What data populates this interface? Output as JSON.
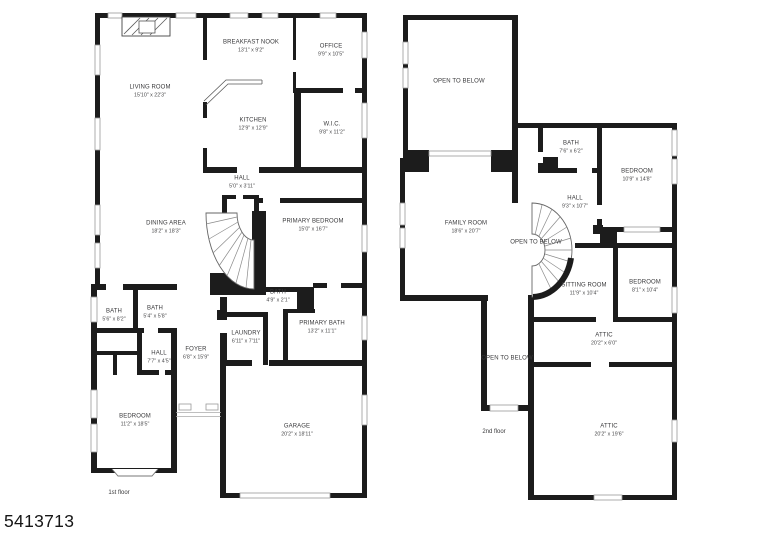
{
  "page": {
    "mls_number": "5413713"
  },
  "colors": {
    "wall": "#1c1c1c",
    "window_line": "#9a9a9a",
    "label_text": "#3a3a3c",
    "background": "#ffffff"
  },
  "floor1": {
    "floor_label": "1st floor",
    "rooms": [
      {
        "name": "LIVING ROOM",
        "dims": "15'10\" x 22'3\""
      },
      {
        "name": "BREAKFAST NOOK",
        "dims": "13'1\" x 9'2\""
      },
      {
        "name": "OFFICE",
        "dims": "9'9\" x 10'5\""
      },
      {
        "name": "KITCHEN",
        "dims": "12'9\" x 12'9\""
      },
      {
        "name": "W.I.C.",
        "dims": "9'8\" x 11'2\""
      },
      {
        "name": "HALL",
        "dims": "5'0\" x 3'11\""
      },
      {
        "name": "DINING AREA",
        "dims": "18'2\" x 18'3\""
      },
      {
        "name": "PRIMARY BEDROOM",
        "dims": "15'0\" x 16'7\""
      },
      {
        "name": "BATH",
        "dims": "5'6\" x 8'2\""
      },
      {
        "name": "BATH",
        "dims": "5'4\" x 5'8\""
      },
      {
        "name": "BATH",
        "dims": "4'9\" x 2'1\""
      },
      {
        "name": "PRIMARY BATH",
        "dims": "13'2\" x 11'1\""
      },
      {
        "name": "LAUNDRY",
        "dims": "6'11\" x 7'11\""
      },
      {
        "name": "FOYER",
        "dims": "6'8\" x 15'9\""
      },
      {
        "name": "HALL",
        "dims": "7'7\" x 4'5\""
      },
      {
        "name": "BEDROOM",
        "dims": "11'2\" x 18'5\""
      },
      {
        "name": "GARAGE",
        "dims": "20'2\" x 18'11\""
      }
    ]
  },
  "floor2": {
    "floor_label": "2nd floor",
    "rooms": [
      {
        "name": "OPEN TO BELOW",
        "dims": ""
      },
      {
        "name": "BATH",
        "dims": "7'6\" x 6'2\""
      },
      {
        "name": "BEDROOM",
        "dims": "10'9\" x 14'8\""
      },
      {
        "name": "FAMILY ROOM",
        "dims": "18'6\" x 20'7\""
      },
      {
        "name": "HALL",
        "dims": "9'3\" x 10'7\""
      },
      {
        "name": "OPEN TO BELOW",
        "dims": ""
      },
      {
        "name": "SITTING ROOM",
        "dims": "11'9\" x 10'4\""
      },
      {
        "name": "BEDROOM",
        "dims": "8'1\" x 10'4\""
      },
      {
        "name": "ATTIC",
        "dims": "20'2\" x 6'0\""
      },
      {
        "name": "OPEN TO BELOW",
        "dims": ""
      },
      {
        "name": "ATTIC",
        "dims": "20'2\" x 19'6\""
      }
    ]
  }
}
